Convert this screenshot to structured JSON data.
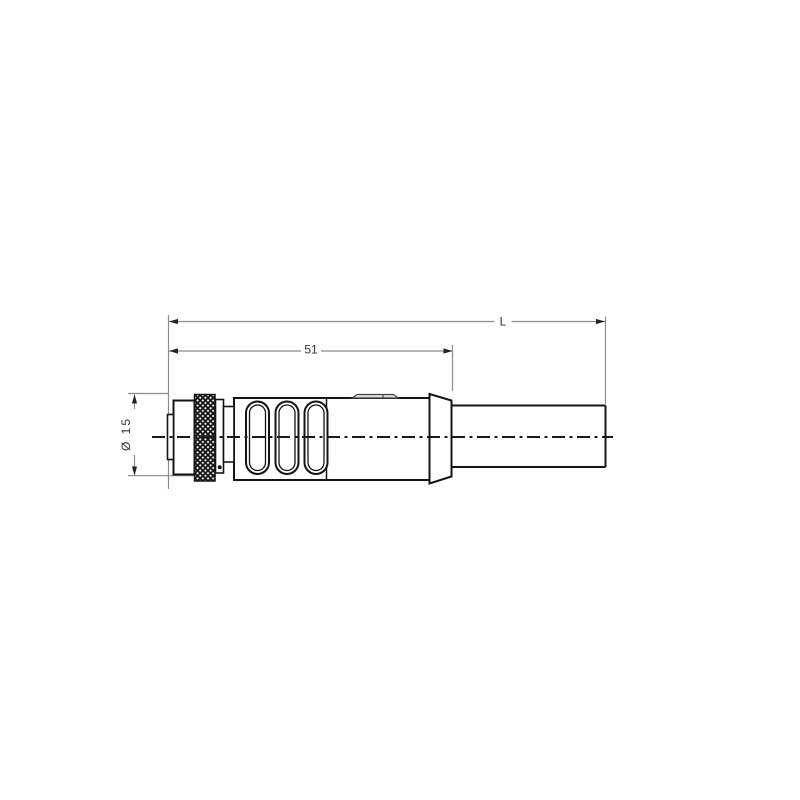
{
  "figure": {
    "type": "engineering-drawing",
    "description": "Side view of a straight molded circular connector (knurled coupling nut, ribbed grip body, bend-relief flange) with attached cable",
    "labels": {
      "overall_length": "L",
      "connector_length": "51",
      "diameter": "Ø 15"
    },
    "colors": {
      "background": "#ffffff",
      "part_outline": "#141414",
      "knurl_fill": "#151515",
      "dimension_line": "#8c8c8c",
      "label_text": "#333333",
      "tab_fill": "#e0e0e0"
    }
  }
}
